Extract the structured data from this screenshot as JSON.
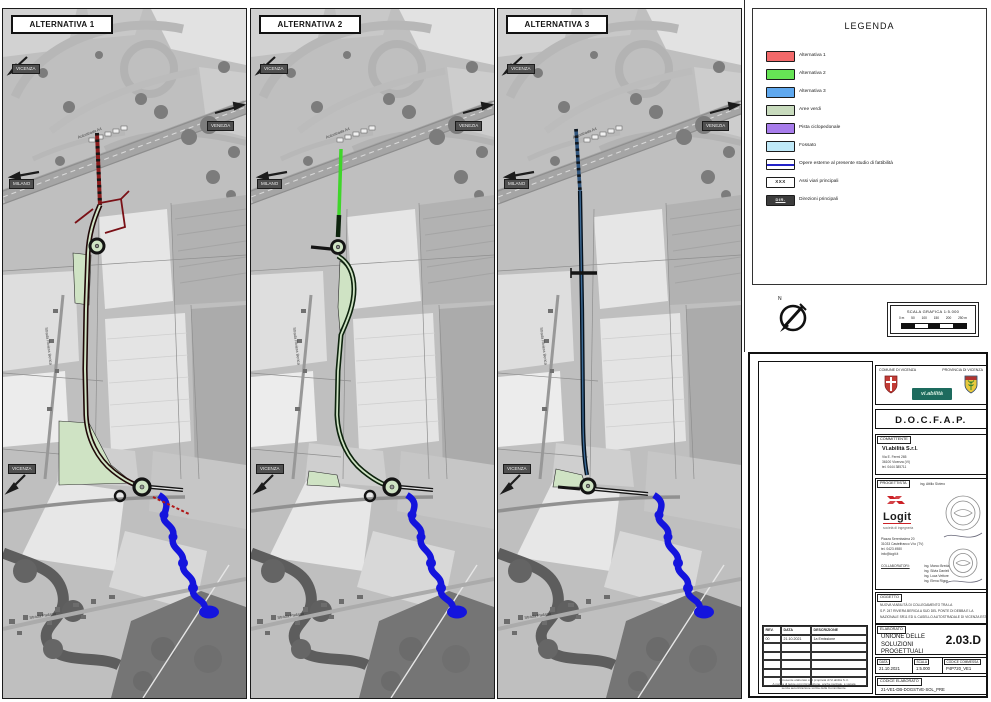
{
  "panels": [
    {
      "title": "ALTERNATIVA 1"
    },
    {
      "title": "ALTERNATIVA 2"
    },
    {
      "title": "ALTERNATIVA 3"
    }
  ],
  "map_labels": {
    "vicenza": "VICENZA",
    "venezia": "VENEZIA",
    "milano": "MILANO",
    "autostrada": "Autostrada A4",
    "riviera": "Strada Riviera Berica",
    "padana": "Strada Padana"
  },
  "legend": {
    "title": "LEGENDA",
    "items": [
      {
        "label": "Alternativa 1",
        "color": "#f2696a"
      },
      {
        "label": "Alternativa 2",
        "color": "#66e455"
      },
      {
        "label": "Alternativa 3",
        "color": "#5fa8ee"
      },
      {
        "label": "Aree verdi",
        "color": "#c8dbbd"
      },
      {
        "label": "Pista ciclopedonale",
        "color": "#a77ceb"
      },
      {
        "label": "Fossato",
        "color": "#bfe9f8"
      },
      {
        "label": "Opere esterne al presente studio di fattibilità",
        "color": "#ffffff"
      },
      {
        "label": "Assi viari principali",
        "color": "#ffffff",
        "text": "XXX"
      },
      {
        "label": "Direzioni principali",
        "color": "#3c3c3c",
        "text": "DIR."
      }
    ]
  },
  "route_colors": {
    "alt1": "#8a1d1d",
    "alt2": "#3fd62a",
    "alt3": "#31567e",
    "aree_verdi": "#cfe3c4",
    "opere_blu": "#1414dd"
  },
  "compass": {
    "n": "N"
  },
  "scalebar": {
    "title": "SCALA GRAFICA 1:5.000",
    "ticks": [
      "0 m",
      "50",
      "100",
      "150",
      "200",
      "250 m"
    ]
  },
  "titleblock": {
    "comune": "COMUNE DI VICENZA",
    "provincia": "PROVINCIA DI VICENZA",
    "viabilita": "vi.abilità",
    "doc_title": "D.O.C.F.A.P.",
    "committente": {
      "label": "COMMITTENTE",
      "name": "Vi.abilità S.r.l.",
      "lines": [
        "Via E. Fermi 265",
        "36100 Vicenza (VI)",
        "tel. 0444 385711"
      ]
    },
    "progettista": {
      "label": "PROGETTISTA",
      "firm": "Logit",
      "tagline": "società di ingegneria",
      "top_engineer": "ing. Attilio Siviero",
      "firm_lines": [
        "Piazza Serenissima 20",
        "31033 Castelfranco V.to (TV)",
        "tel. 0423 4980",
        "info@logit.it"
      ],
      "team_label": "COLLABORATORI:",
      "team": [
        "ing. Marco Breda",
        "ing. Silvia Danieli",
        "ing. Luca Vettore",
        "ing. Elena Rigon"
      ]
    },
    "oggetto": {
      "label": "OGGETTO",
      "lines": [
        "NUOVA VIABILITÀ DI COLLEGAMENTO TRA LA",
        "S.P. 247 RIVIERA BERICA A SUD DEL PONTE DI DEBBA E LA",
        "NAZIONALE SR11 ED IL CASELLO AUTOSTRADALE DI VICENZA EST"
      ]
    },
    "elaborato": {
      "label": "ELABORATO",
      "name": "UNIONE DELLE SOLUZIONI PROGETTUALI",
      "code": "2.03.D"
    },
    "meta": {
      "data_label": "DATA",
      "data": "21.10.2021",
      "scala_label": "SCALA",
      "scala": "1:5.000",
      "commessa_label": "CODICE COMMESSA",
      "commessa": "P4P720_VE1",
      "codice_label": "CODICE ELABORATO",
      "codice": "21-VE1-DB-DOGSTVE-SOL_PRE"
    },
    "revisions": {
      "headers": [
        "REV.",
        "DATA",
        "DESCRIZIONE"
      ],
      "rows": [
        [
          "00",
          "21.10.2021",
          "1a Emissione"
        ],
        [
          "",
          "",
          ""
        ],
        [
          "",
          "",
          ""
        ],
        [
          "",
          "",
          ""
        ],
        [
          "",
          "",
          ""
        ],
        [
          "",
          "",
          ""
        ]
      ],
      "fineprint": [
        "Il presente elaborato è di proprietà di Vi.abilità S.r.l.",
        "A norma di legge ogni riproduzione, anche parziale, è vietata",
        "senza autorizzazione scritta della Committente."
      ]
    }
  }
}
